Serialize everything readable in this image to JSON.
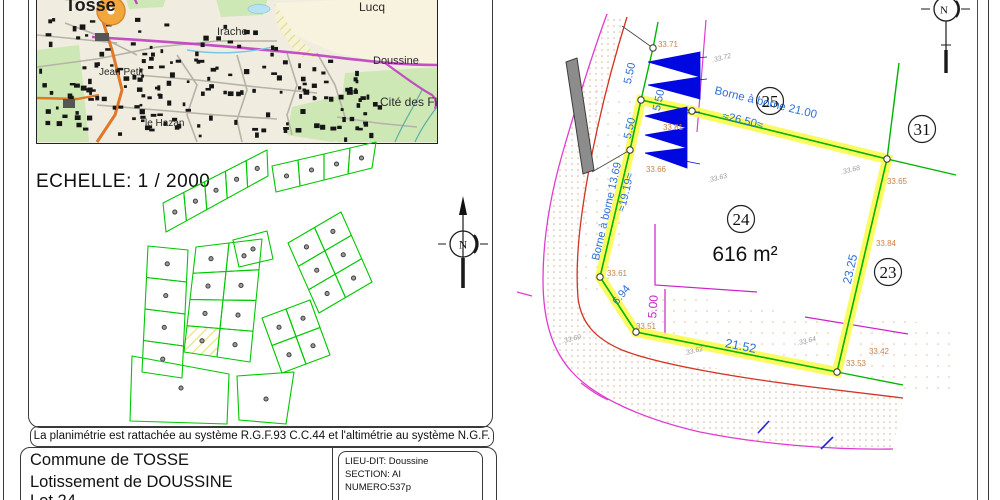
{
  "map": {
    "town": "Tosse",
    "labels": {
      "lucq": "Lucq",
      "irache": "Irache",
      "doussine": "Doussine",
      "jean_petit": "Jean Petit",
      "cite_des_fleurs": "Cité des Fleurs",
      "le_hazan": "le Hazan"
    }
  },
  "scale_label": "ECHELLE: 1 / 2000",
  "north_label": "N",
  "footer": {
    "georef_note": "La planimétrie est rattachée au système R.G.F.93 C.C.44 et l'altimétrie au système N.G.F.",
    "commune": "Commune de TOSSE",
    "lotissement": "Lotissement de DOUSSINE",
    "lot": "Lot 24",
    "lieu_dit": "LIEU-DIT: Doussine",
    "section": "SECTION: AI",
    "numero": "NUMERO:537p"
  },
  "plan": {
    "area": "616 m²",
    "lots": {
      "current": "24",
      "north": "25",
      "east": "31",
      "southeast": "23"
    },
    "dims": {
      "borne_21": "Borne à borne 21.00",
      "approx_26_50": "≈26.50≈",
      "borne_13_69": "Borne à borne 13.69",
      "approx_19_19": "≈19.19≈",
      "d550_a": "5.50",
      "d550_b": "5.50",
      "d550_c": "5.50",
      "d2152": "21.52",
      "d2325": "23.25",
      "d694": "6.94",
      "d500": "5.00"
    },
    "spot_elevations": {
      "e3371": "33.71",
      "e3381": "33.81",
      "e3366": "33.66",
      "e3365": "33.65",
      "e3384": "33.84",
      "e3361": "33.61",
      "e3351": "33.51",
      "e3342": "33.42",
      "e3353": "33.53"
    },
    "ground_elevations": {
      "g1": ".33.72",
      "g2": ".33.68",
      "g3": ".33.63",
      "g4": ".33.69",
      "g5": ".33.62",
      "g6": ".33.64"
    }
  },
  "colors": {
    "boundary_green": "#00b400",
    "lots_green": "#00c800",
    "highlight_yellow": "#fbfb58",
    "dim_blue": "#2e6fd8",
    "setback_magenta": "#cc22cc",
    "road_magenta": "#e03cd0",
    "road_red": "#d03424",
    "elevation_orange": "#c8824a",
    "ground_gray": "#9a9a9a",
    "talus_blue": "#0008e0"
  }
}
